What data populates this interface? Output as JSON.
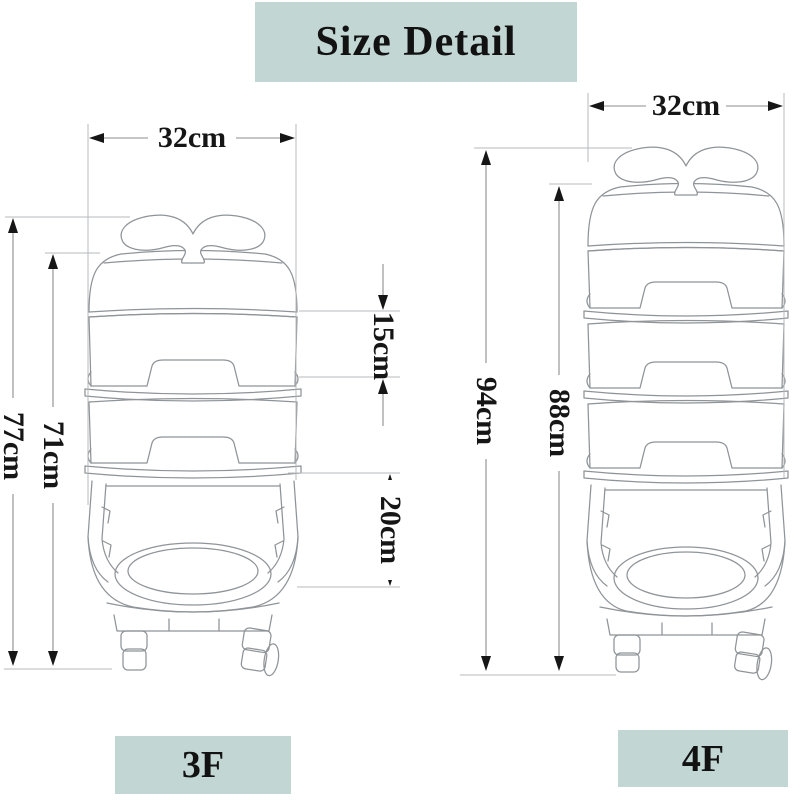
{
  "title": "Size Detail",
  "colors": {
    "accent_bg": "#c2d7d4",
    "drawing_line": "#8f9498",
    "dimension_line": "#8e8e8e",
    "text": "#161616"
  },
  "left_cart": {
    "name": "3F",
    "width": "32cm",
    "total_height": "77cm",
    "body_height": "71cm",
    "tier_height": "15cm",
    "basket_height": "20cm"
  },
  "right_cart": {
    "name": "4F",
    "width": "32cm",
    "total_height": "94cm",
    "body_height": "88cm"
  }
}
